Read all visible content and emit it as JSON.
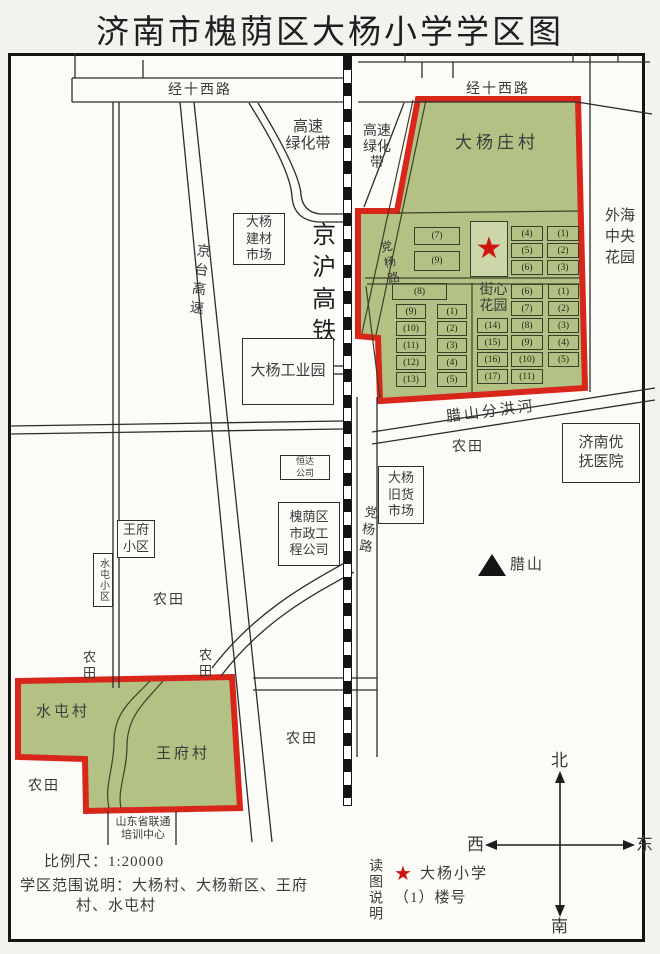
{
  "title": "济南市槐荫区大杨小学学区图",
  "roads": {
    "jingshi_west": "经十西路",
    "jingtai_expwy": "京台高速",
    "jinghu_railway": "京沪高铁",
    "dangyang_road": "党杨路",
    "greenbelt_left": [
      "高速",
      "绿化带"
    ],
    "greenbelt_right": [
      "高速",
      "绿化",
      "带"
    ],
    "river": "腊山分洪河"
  },
  "zones": {
    "dayangzhuang": "大杨庄村",
    "shuitun": "水屯村",
    "wangfu": "王府村",
    "street_garden": [
      "街心",
      "花园"
    ],
    "waihai_garden": [
      "外海",
      "中央",
      "花园"
    ]
  },
  "places": {
    "building_market": [
      "大杨",
      "建材",
      "市场"
    ],
    "industrial_park": "大杨工业园",
    "hengda": [
      "恒达",
      "公司"
    ],
    "municipal": [
      "槐荫区",
      "市政工",
      "程公司"
    ],
    "junk_market": [
      "大杨",
      "旧货",
      "市场"
    ],
    "hospital": [
      "济南优",
      "抚医院"
    ],
    "wangfu_estate": [
      "王府",
      "小区"
    ],
    "shuitun_estate": "水屯小区",
    "unicom_center": [
      "山东省联通",
      "培训中心"
    ],
    "lashan": "腊山",
    "farmland": "农田"
  },
  "buildings": {
    "upper_left": [
      "(7)",
      "(9)"
    ],
    "upper_right": [
      [
        "(4)",
        "(1)"
      ],
      [
        "(5)",
        "(2)"
      ],
      [
        "(6)",
        "(3)"
      ]
    ],
    "lower_single": "(8)",
    "lower_left": [
      [
        "(9)",
        "(1)"
      ],
      [
        "(10)",
        "(2)"
      ],
      [
        "(11)",
        "(3)"
      ],
      [
        "(12)",
        "(4)"
      ],
      [
        "(13)",
        "(5)"
      ]
    ],
    "lower_right": [
      [
        "(6)",
        "(1)"
      ],
      [
        "(7)",
        "(2)"
      ],
      [
        "(14)",
        "(8)",
        "(3)"
      ],
      [
        "(15)",
        "(9)",
        "(4)"
      ],
      [
        "(16)",
        "(10)",
        "(5)"
      ],
      [
        "(17)",
        "(11)"
      ]
    ]
  },
  "compass": {
    "north": "北",
    "south": "南",
    "west": "西",
    "east": "东"
  },
  "legend": {
    "scale": "比例尺：1:20000",
    "zone_note_line1": "学区范围说明：大杨村、大杨新区、王府",
    "zone_note_line2": "村、水屯村",
    "reading_note": "读图说明",
    "star_icon": "★",
    "school_label": "大杨小学",
    "building_no_label": "（1）楼号"
  },
  "colors": {
    "zone_fill": "#b3c184",
    "zone_border": "#d8261a",
    "star": "#cc1410"
  }
}
